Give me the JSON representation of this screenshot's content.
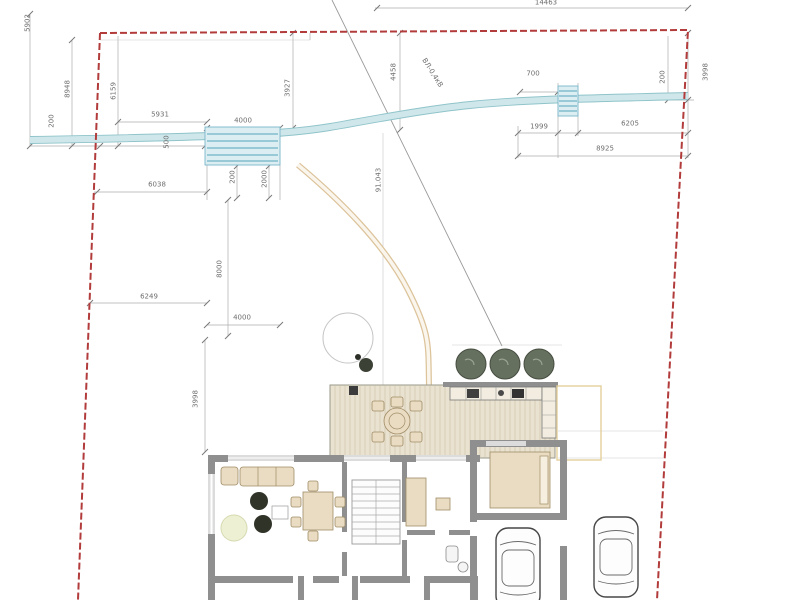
{
  "annotations": {
    "power_line": "ВЛ-0,4кВ",
    "elevation": "91.043"
  },
  "dimensions": {
    "top_width": "14463",
    "left_outer": "5902",
    "left_8948": "8948",
    "left_200": "200",
    "left_6159": "6159",
    "h_5931": "5931",
    "h_4000_top": "4000",
    "v_3927": "3927",
    "v_500": "500",
    "v_4458": "4458",
    "h_700": "700",
    "h_1999": "1999",
    "h_6205": "6205",
    "h_8925": "8925",
    "v_200_right": "200",
    "v_3998_right": "3998",
    "v_200_bridge": "200",
    "v_2000": "2000",
    "h_6038": "6038",
    "h_6249": "6249",
    "v_8000": "8000",
    "h_4000_bottom": "4000",
    "v_3998_left": "3998"
  },
  "colors": {
    "boundary": "#b23b3b",
    "water": "#8fc4ca",
    "water_light": "#cfe7ea",
    "path": "#dcc39a",
    "deck": "#eae2d0",
    "wall": "#8f8f8f",
    "furniture": "#e9dcc3",
    "tree": "#66705f"
  }
}
